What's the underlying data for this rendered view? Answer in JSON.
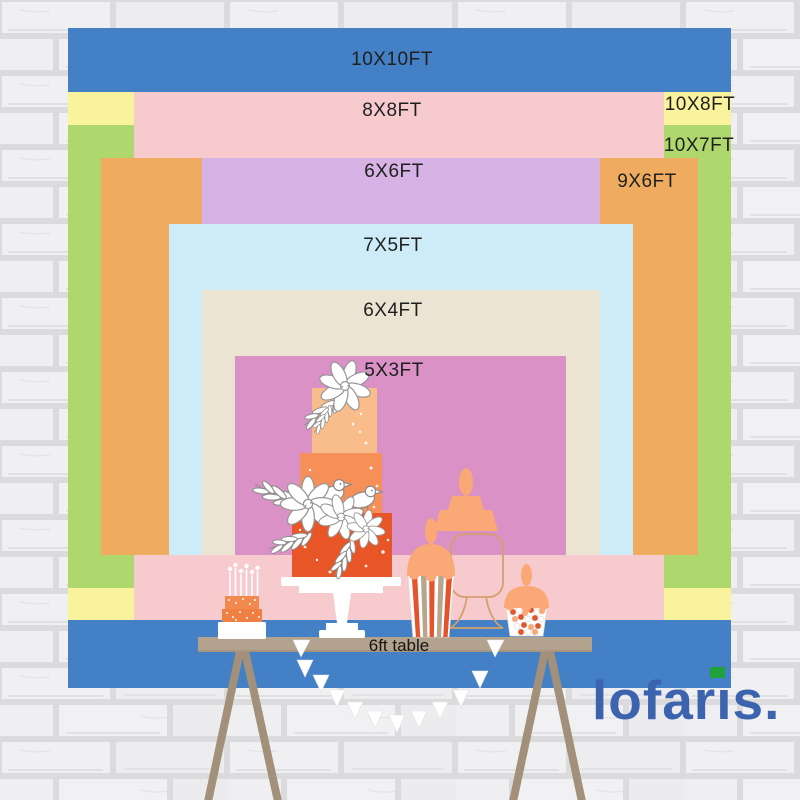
{
  "sizes": [
    {
      "label": "10X10FT",
      "width_ft": 10,
      "height_ft": 10,
      "color": "#4480c5"
    },
    {
      "label": "10X8FT",
      "width_ft": 10,
      "height_ft": 8,
      "color": "#f9f39d"
    },
    {
      "label": "10X7FT",
      "width_ft": 10,
      "height_ft": 7,
      "color": "#aed86d"
    },
    {
      "label": "8X8FT",
      "width_ft": 8,
      "height_ft": 8,
      "color": "#f7cacd"
    },
    {
      "label": "9X6FT",
      "width_ft": 9,
      "height_ft": 6,
      "color": "#efac61"
    },
    {
      "label": "6X6FT",
      "width_ft": 6,
      "height_ft": 6,
      "color": "#d6b2e5"
    },
    {
      "label": "7X5FT",
      "width_ft": 7,
      "height_ft": 5,
      "color": "#cdecf7"
    },
    {
      "label": "6X4FT",
      "width_ft": 6,
      "height_ft": 4,
      "color": "#ece4d2"
    },
    {
      "label": "5X3FT",
      "width_ft": 5,
      "height_ft": 3,
      "color": "#d991c6"
    }
  ],
  "table": {
    "label": "6ft table",
    "color": "#b3a28d"
  },
  "logo": {
    "part1": "lofar",
    "part2": "ıs",
    "period": ".",
    "color": "#3b63ae",
    "accent_color": "#1fa23a"
  }
}
